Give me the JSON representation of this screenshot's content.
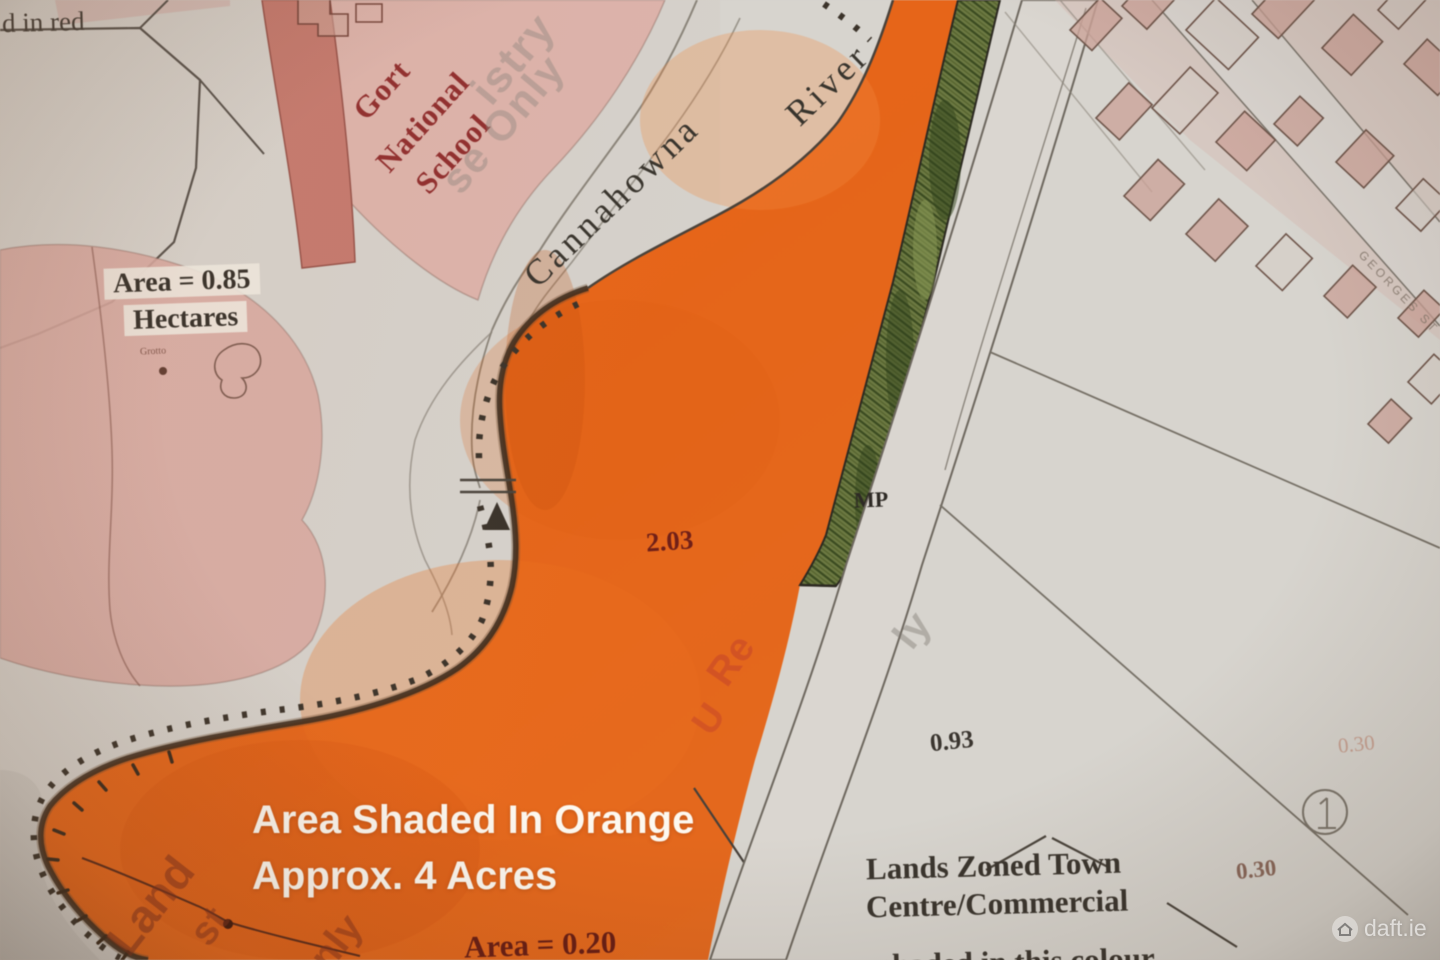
{
  "labels": {
    "top_left_partial": "d in red",
    "area_hectares_value": "Area = 0.85",
    "area_hectares_unit": "Hectares",
    "grotto": "Grotto",
    "school_word1": "Gort",
    "school_word2": "National",
    "school_word3": "School",
    "river_word1": "Cannahowna",
    "river_word2": "River",
    "parcel_area_203": "2.03",
    "mp_marker": "MP",
    "parcel_area_093": "0.93",
    "parcel_area_030_faint": "0.30",
    "parcel_area_030": "0.30",
    "area_020_partial": "Area = 0.20",
    "street_name_partial": "GEORGES ST"
  },
  "zoning_note": {
    "line1": "Lands Zoned Town",
    "line2": "Centre/Commercial",
    "line3_partial": "shaded in this colour"
  },
  "orange_annotation": {
    "line1": "Area Shaded In Orange",
    "line2": "Approx. 4 Acres"
  },
  "watermark_fragments": {
    "registry1": "istry",
    "registry2": "se Only",
    "registry3": "ly",
    "registry4": "Land",
    "registry5": "st",
    "registry6": "nly",
    "registry7": "Re",
    "registry8": "U"
  },
  "brand_watermark": "daft.ie",
  "colors": {
    "paper": "#d5d1cb",
    "orange_shade": "#e8702a",
    "pink_shade": "#d7a9a2",
    "dark_red_band": "#c27a6f",
    "green_strip": "#6d7a45",
    "map_line": "#4a443c",
    "red_label_text": "#8c2e2e",
    "annotation_white": "#fdf8f0"
  }
}
